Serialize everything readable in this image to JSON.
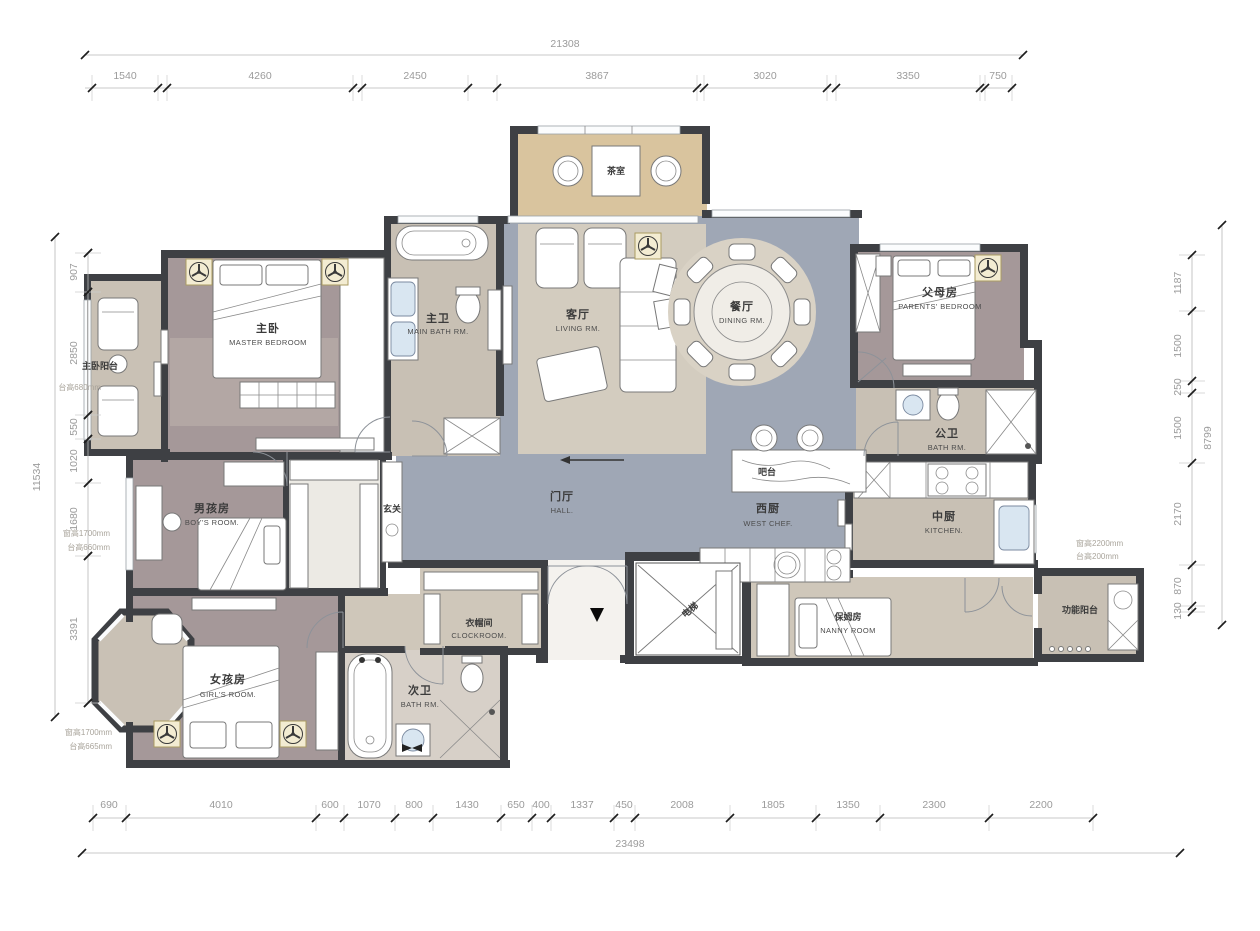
{
  "drawing": {
    "rooms": {
      "master": {
        "zh": "主卧",
        "en": "MASTER BEDROOM"
      },
      "master_balcony": {
        "zh": "主卧阳台",
        "en": ""
      },
      "main_bath": {
        "zh": "主卫",
        "en": "MAIN BATH RM."
      },
      "tea_room": {
        "zh": "茶室",
        "en": ""
      },
      "living": {
        "zh": "客厅",
        "en": "LIVING RM."
      },
      "dining": {
        "zh": "餐厅",
        "en": "DINING RM."
      },
      "parents": {
        "zh": "父母房",
        "en": "PARENTS' BEDROOM"
      },
      "public_bath": {
        "zh": "公卫",
        "en": "BATH RM."
      },
      "hall": {
        "zh": "门厅",
        "en": "HALL."
      },
      "foyer": {
        "zh": "玄关",
        "en": ""
      },
      "bar": {
        "zh": "吧台",
        "en": ""
      },
      "west_kitchen": {
        "zh": "西厨",
        "en": "WEST CHEF."
      },
      "kitchen": {
        "zh": "中厨",
        "en": "KITCHEN."
      },
      "boys": {
        "zh": "男孩房",
        "en": "BOY'S ROOM."
      },
      "cloakroom": {
        "zh": "衣帽间",
        "en": "CLOCKROOM."
      },
      "girls": {
        "zh": "女孩房",
        "en": "GIRL'S ROOM."
      },
      "second_bath": {
        "zh": "次卫",
        "en": "BATH RM."
      },
      "nanny": {
        "zh": "保姆房",
        "en": "NANNY ROOM"
      },
      "elevator": {
        "zh": "电梯",
        "en": ""
      },
      "function_balcony": {
        "zh": "功能阳台",
        "en": ""
      }
    },
    "dims": {
      "top_total": "21308",
      "top": [
        "1540",
        "4260",
        "2450",
        "3867",
        "3020",
        "3350",
        "750"
      ],
      "bottom_total": "23498",
      "bottom": [
        "690",
        "4010",
        "600",
        "1070",
        "800",
        "1430",
        "650",
        "400",
        "1337",
        "450",
        "2008",
        "1805",
        "1350",
        "2300",
        "2200"
      ],
      "left_total": "11534",
      "left": [
        "907",
        "2850",
        "550",
        "1020",
        "1680",
        "3391"
      ],
      "right_total": "8799",
      "right": [
        "1187",
        "1500",
        "250",
        "1500",
        "2170",
        "870",
        "130"
      ]
    },
    "notes": {
      "balcony_sill": "台高680mm",
      "boys_win_h": "窗高1700mm",
      "boys_sill": "台高660mm",
      "girls_win_h": "窗高1700mm",
      "girls_sill": "台高665mm",
      "kitchen_win_h": "窗高2200mm",
      "kitchen_sill": "台高200mm"
    },
    "colors": {
      "wall": "#3e4044",
      "floor_public": "#9fa7b5",
      "floor_bedroom": "#a59899",
      "floor_stone": "#c8c0b4",
      "floor_wood": "#d9c49e"
    }
  }
}
